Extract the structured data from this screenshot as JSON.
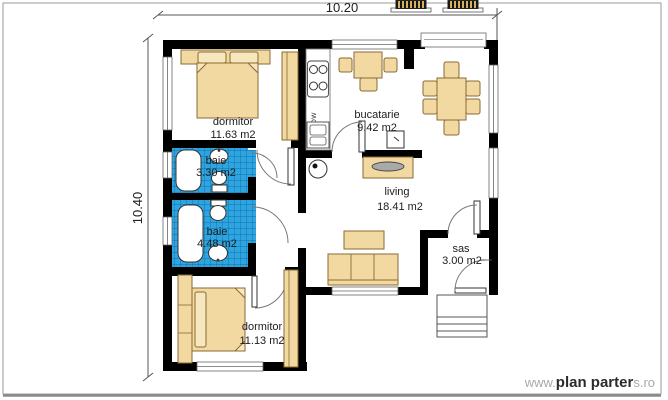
{
  "dimensions": {
    "top_width": "10.20",
    "left_height": "10.40"
  },
  "rooms": {
    "dormitor_top": {
      "name": "dormitor",
      "area": "11.63 m2"
    },
    "baie_small": {
      "name": "baie",
      "area": "3.30 m2"
    },
    "baie_large": {
      "name": "baie",
      "area": "4.48 m2"
    },
    "dormitor_bottom": {
      "name": "dormitor",
      "area": "11.13 m2"
    },
    "bucatarie": {
      "name": "bucatarie",
      "area": "9.42 m2"
    },
    "living": {
      "name": "living",
      "area": "18.41 m2"
    },
    "sas": {
      "name": "sas",
      "area": "3.00 m2"
    }
  },
  "appliances": {
    "dishwasher": "DW"
  },
  "watermark": {
    "prefix": "www.",
    "brand": "plan parter",
    "suffix": "s.ro"
  },
  "colors": {
    "wall": "#000000",
    "furniture": "#F2D9A2",
    "furniture_border": "#8A6A33",
    "tile_blue": "#2EA5E0",
    "tile_grid": "#1070A8",
    "dimension_line": "#555555",
    "watermark_gray": "#A9A9A9"
  }
}
